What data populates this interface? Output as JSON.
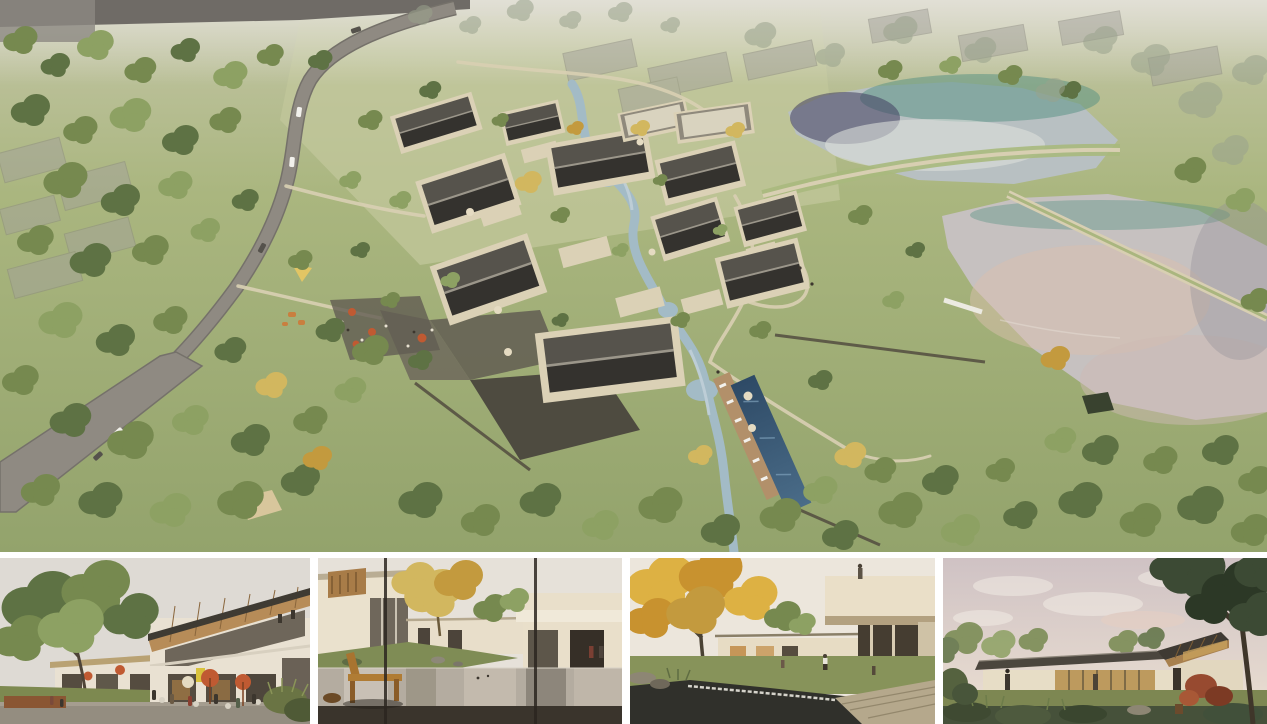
{
  "page": {
    "title": "Architectural rendering board — lakeside village resort",
    "background": "#ffffff"
  },
  "palette": {
    "grassTop": "#c9cbae",
    "grassMid": "#aab67f",
    "grassDeep": "#93a36c",
    "meadow": "#c2c79b",
    "haze": "#dddcd2",
    "roadGray": "#8f8a82",
    "roadDark": "#75716a",
    "pathBeige": "#d8cfb2",
    "stoneDark": "#4a463d",
    "stoneMid": "#625d52",
    "wallCream": "#dbd1b6",
    "cream": "#e9e1d2",
    "roofTop": "#56534c",
    "roofSide": "#34322e",
    "ridgeGray": "#9b968a",
    "pavTop": "#d9d3bf",
    "pavEdge": "#8f897c",
    "stream": "#a3bbc6",
    "lakeBase": "#b8c0c2",
    "lakeTeal": "#549082",
    "lakeNavy": "#413e60",
    "lakeSheen": "#dcdfda",
    "lakeLowBase": "#c6c1c0",
    "lakePink": "#dabfae",
    "poolBlue": "#3d5f7e",
    "deckWood": "#b2906a",
    "lounger": "#eceae2",
    "treeDark": "#5e7244",
    "treeMid": "#76894f",
    "treeLight": "#8da163",
    "treePale": "#a9b97d",
    "treeGold": "#d2b75f",
    "treeGoldDeep": "#c39a3e",
    "treeHazy": "#9aa28c",
    "canopyDark": "#3c4a34",
    "canopyDeep": "#2c3826",
    "autumn1": "#ddb143",
    "autumn2": "#c8922f",
    "redShrub": "#974a30",
    "umbOrange": "#c05a32",
    "umbCream": "#e5dbc2",
    "sky1": "#dedad4",
    "sky2": "#e6e1d9",
    "sky3": "#ece6dc",
    "sky4top": "#cfc2c4",
    "sky4bot": "#ece0d2",
    "glassDark": "#554c40",
    "glassWarm": "#c08a45",
    "woodWarm": "#b78c58",
    "woodDeep": "#8a663c",
    "benchWood": "#b07c34",
    "deckDark": "#3a342c",
    "shrubDark": "#46513a",
    "signYellow": "#d9c23c",
    "figDark": "#3c362e",
    "pondDark": "#30302b",
    "stoneLedge": "#b5a88c",
    "waterGray": "#b4aca0"
  },
  "main_view": {
    "label": "aerial-masterplan-rendering",
    "description": "Aerial rendering of a lakeside village resort: cream houses with dark gabled roofs clustered around a winding stream, a swimming pool with sun deck, stone terraces and cafe umbrellas, a curving access road through woodland on the left, translucent massing of existing structures, and two reflective lakes joined by a grassy causeway on the right."
  },
  "thumbnails": [
    {
      "label": "street-cafe-view",
      "description": "Eye-level view of a two-storey building with an exposed-rafter monopitch roof, outdoor cafe seating with orange parasols, a yellow sign and a large tree."
    },
    {
      "label": "courtyard-pool-view",
      "description": "Courtyard with a still reflecting pool, a wooden bench and stool in the foreground, cream villas and a golden tree, seen through window mullions."
    },
    {
      "label": "garden-pond-view",
      "description": "Garden courtyard with a pond and stone weir, a large autumn tree, low cream buildings and a cantilevered balcony with a person on top."
    },
    {
      "label": "lakeside-pavilion-view",
      "description": "Single-storey glass pavilion with a dark low-pitched roof and raised timber clerestory, on a lawn with shrubs, a red maple and a dusk sky."
    }
  ]
}
